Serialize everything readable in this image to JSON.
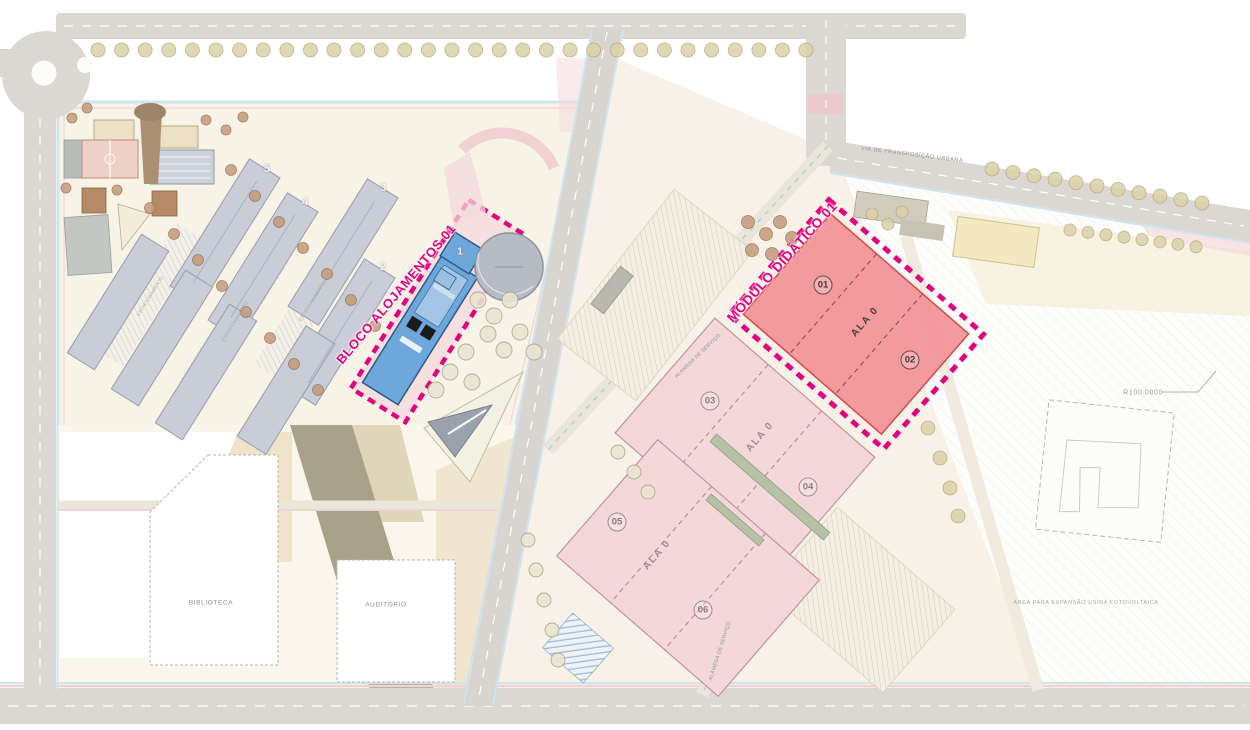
{
  "highlights": {
    "bloco_alojamentos": {
      "label": "BLOCO ALOJAMENTOS 01",
      "building_number": "1"
    },
    "modulo_didatico": {
      "label": "MÓDULO DIDÁTICO 01",
      "unit_a": "01",
      "unit_b": "02",
      "wing": "ALA 0"
    }
  },
  "blocks": {
    "block_0304": {
      "unit_a": "03",
      "unit_b": "04",
      "wing": "ALA 0"
    },
    "block_0506": {
      "unit_a": "05",
      "unit_b": "06",
      "wing": "ALA 0"
    }
  },
  "campus": {
    "building_numbers": [
      "5",
      "4",
      "3",
      "2"
    ],
    "parking_label": "ESTACIONAMENTO"
  },
  "public_buildings": {
    "biblioteca": "BIBLIOTECA",
    "auditorio": "AUDITÓRIO"
  },
  "roads": {
    "alameda_servico": "ALAMEDA DE SERVIÇO",
    "via_transposicao": "VIA DE TRANSPOSIÇÃO URBANA"
  },
  "annotations": {
    "radius": "R100.0000",
    "expansion_area": "ÁREA PARA EXPANSÃO USINA FOTOVOLTAICA"
  },
  "colors": {
    "highlight_magenta": "#e6007e",
    "modulo_fill": "#f29599",
    "bloco_fill": "#6ea7d9",
    "block_pink": "#f4d7d9",
    "road_grey": "#dbd8d3",
    "cycle_blue": "#cfe4ef"
  }
}
